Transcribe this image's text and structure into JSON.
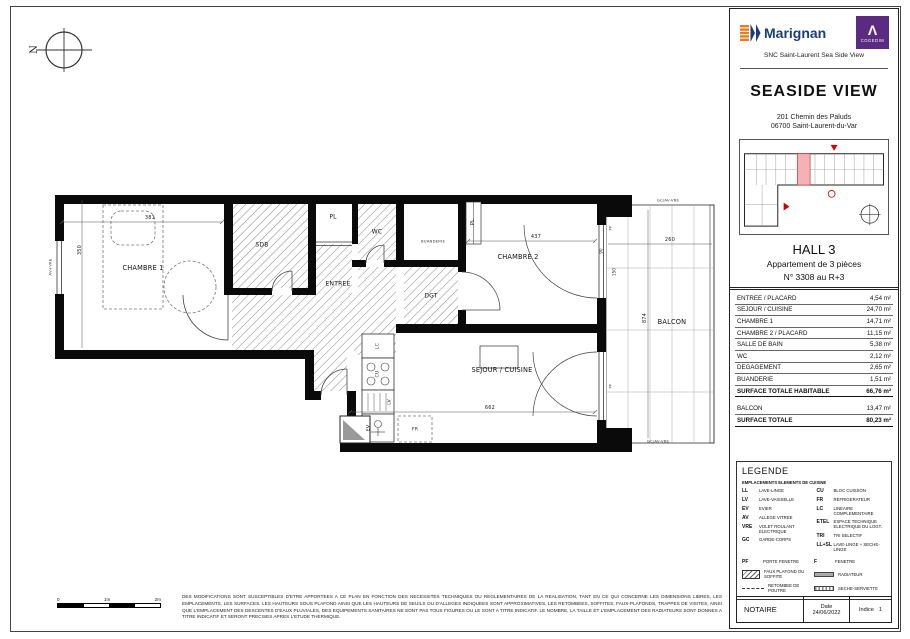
{
  "brand": {
    "marignan": "Marignan",
    "cogedim": "COGEDIM",
    "cogedim_mark": "Λ",
    "snc": "SNC Saint-Laurent Sea Side View"
  },
  "project": {
    "name": "SEASIDE VIEW",
    "address1": "201 Chemin des Paluds",
    "address2": "06700 Saint-Laurent-du-Var"
  },
  "unit": {
    "hall": "HALL 3",
    "type": "Appartement de 3 pièces",
    "number": "N° 3308 au R+3"
  },
  "areas": {
    "rows": [
      {
        "label": "ENTREE / PLACARD",
        "value": "4,54 m²"
      },
      {
        "label": "SEJOUR / CUISINE",
        "value": "24,70 m²"
      },
      {
        "label": "CHAMBRE 1",
        "value": "14,71 m²"
      },
      {
        "label": "CHAMBRE 2 / PLACARD",
        "value": "11,15 m²"
      },
      {
        "label": "SALLE DE BAIN",
        "value": "5,38 m²"
      },
      {
        "label": "WC",
        "value": "2,12 m²"
      },
      {
        "label": "DEGAGEMENT",
        "value": "2,65 m²"
      },
      {
        "label": "BUANDERIE",
        "value": "1,51 m²"
      }
    ],
    "total_habitable": {
      "label": "SURFACE TOTALE HABITABLE",
      "value": "66,76 m²"
    },
    "balcon": {
      "label": "BALCON",
      "value": "13,47 m²"
    },
    "total": {
      "label": "SURFACE TOTALE",
      "value": "80,23 m²"
    }
  },
  "legend": {
    "title": "LEGENDE",
    "subtitle": "EMPLACEMENTS ELEMENTS DE CUISINE",
    "items": [
      {
        "abbr": "LL",
        "label": "LAVE-LINGE"
      },
      {
        "abbr": "LV",
        "label": "LAVE-VAISSELLE"
      },
      {
        "abbr": "EV",
        "label": "EVIER"
      },
      {
        "abbr": "AV",
        "label": "ALLEGE VITREE"
      },
      {
        "abbr": "VRE",
        "label": "VOLET ROULANT ELECTRIQUE"
      },
      {
        "abbr": "GC",
        "label": "GARDE-CORPS"
      },
      {
        "abbr": "CU",
        "label": "BLOC CUISSON"
      },
      {
        "abbr": "FR",
        "label": "REFRIGERATEUR"
      },
      {
        "abbr": "LC",
        "label": "LINEAIRE COMPLEMENTAIRE"
      },
      {
        "abbr": "ETEL",
        "label": "ESPACE TECHNIQUE ELECTRIQUE DU LOGT."
      },
      {
        "abbr": "TRI",
        "label": "TRI SELECTIF"
      },
      {
        "abbr": "LL+SL",
        "label": "LAVE-LINGE + SECHE-LINGE"
      }
    ],
    "pf_abbr": "PF",
    "pf_label": "PORTE FENETRE",
    "f_abbr": "F",
    "f_label": "FENETRE",
    "faux_plafond": "FAUX PLAFOND OU SOFFITE",
    "radiateur": "RADIATEUR",
    "retombee": "RETOMBEE DE POUTRE",
    "seche_serviette": "SECHE-SERVIETTE"
  },
  "footer": {
    "notaire": "NOTAIRE",
    "date_label": "Date",
    "date_value": "24/06/2022",
    "indice_label": "Indice",
    "indice_value": "1"
  },
  "plan": {
    "rooms": {
      "chambre1": "CHAMBRE 1",
      "sdb": "SDB",
      "pl": "PL",
      "wc": "WC",
      "buanderie": "BUANDERIE",
      "pl2": "PL",
      "dgt": "DGT",
      "entree": "ENTREE",
      "chambre2": "CHAMBRE 2",
      "sejour": "SEJOUR / CUISINE",
      "balcon": "BALCON"
    },
    "kitchen": {
      "lc": "LC",
      "cu": "CU",
      "lv": "LV",
      "ev": "EV",
      "fr": "FR"
    },
    "dims": {
      "chambre1_w": "381",
      "chambre1_h": "350",
      "chambre2_w": "437",
      "sejour_w": "662",
      "balcon_h": "874",
      "balcon_w": "260",
      "door_a": "90",
      "door_b": "150"
    },
    "annotations": {
      "pf1": "PF",
      "pf2": "PF",
      "left_window": "AV+VRE",
      "balcony_top": "GC/AV-VRE",
      "balcony_bottom": "GC/AV-VRE"
    },
    "compass": "N",
    "scale": {
      "s0": "0",
      "s1": "1m",
      "s2": "2m"
    },
    "disclaimer": "DES MODIFICATIONS SONT SUSCEPTIBLES D'ETRE APPORTEES A CE PLAN EN FONCTION DES NECESSITES TECHNIQUES OU REGLEMENTAIRES DE LA REALISATION, TANT EN CE QUI CONCERNE LES DIMENSIONS LIBRES, LES EMPLACEMENTS, LES SURFACES. LES HAUTEURS SOUS PLAFOND AINSI QUE LES HAUTEURS DE SEUILS OU D'ALLEGES INDIQUEES SONT APPROXIMATIVES. LES RETOMBEES, SOFFITES, FAUX-PLAFONDS, TRAPPES DE VISITES, AINSI QUE L'EMPLACEMENT DES DESCENTES D'EAUX PLUVIALES, DES EQUIPEMENTS SANITAIRES NE SONT PAS TOUS FIGURES OU LE SONT A TITRE INDICATIF. LE NOMBRE, LA TAILLE ET L'EMPLACEMENT DES RADIATEURS SONT DONNES A TITRE INDICATIF ET SERONT PRECISES APRES L'ETUDE THERMIQUE."
  }
}
